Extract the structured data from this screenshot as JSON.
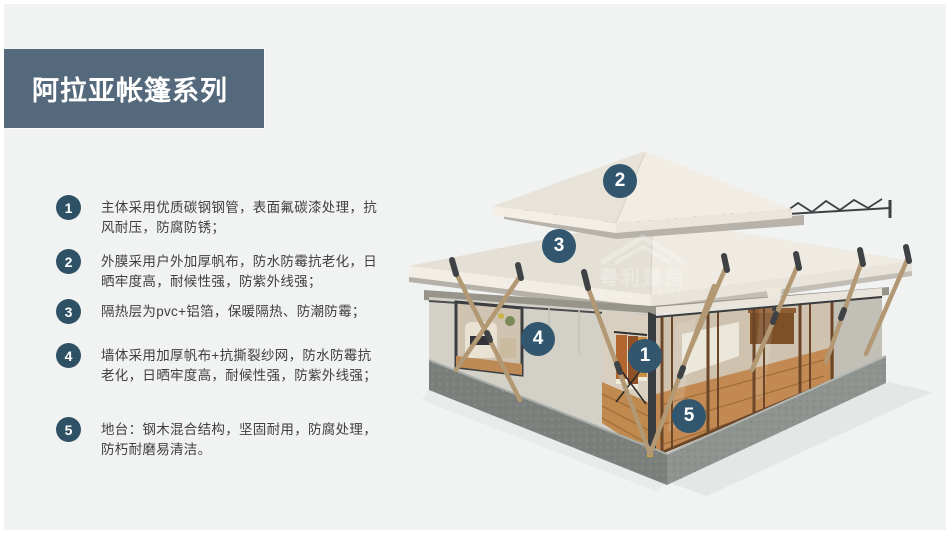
{
  "page": {
    "background_color": "#f1f2f2",
    "frame_color": "#ffffff"
  },
  "header": {
    "title": "阿拉亚帐篷系列",
    "banner_color": "#55697c"
  },
  "features": [
    {
      "num": "1",
      "text": "主体采用优质碳钢钢管，表面氟碳漆处理，抗风耐压，防腐防锈；"
    },
    {
      "num": "2",
      "text": "外膜采用户外加厚帆布，防水防霉抗老化，日晒牢度高，耐候性强，防紫外线强；"
    },
    {
      "num": "3",
      "text": "隔热层为pvc+铝箔，保暖隔热、防潮防霉；"
    },
    {
      "num": "4",
      "text": "墙体采用加厚帆布+抗撕裂纱网，防水防霉抗老化，日晒牢度高，耐候性强，防紫外线强；"
    },
    {
      "num": "5",
      "text": "地台：钢木混合结构，坚固耐用，防腐处理，防朽耐磨易清洁。"
    }
  ],
  "image": {
    "callout_color": "#31566e",
    "callouts": [
      {
        "num": "1"
      },
      {
        "num": "2"
      },
      {
        "num": "3"
      },
      {
        "num": "4"
      },
      {
        "num": "5"
      }
    ],
    "watermark": {
      "cn": "粤利篷房",
      "en": "YUELI TENT"
    }
  }
}
